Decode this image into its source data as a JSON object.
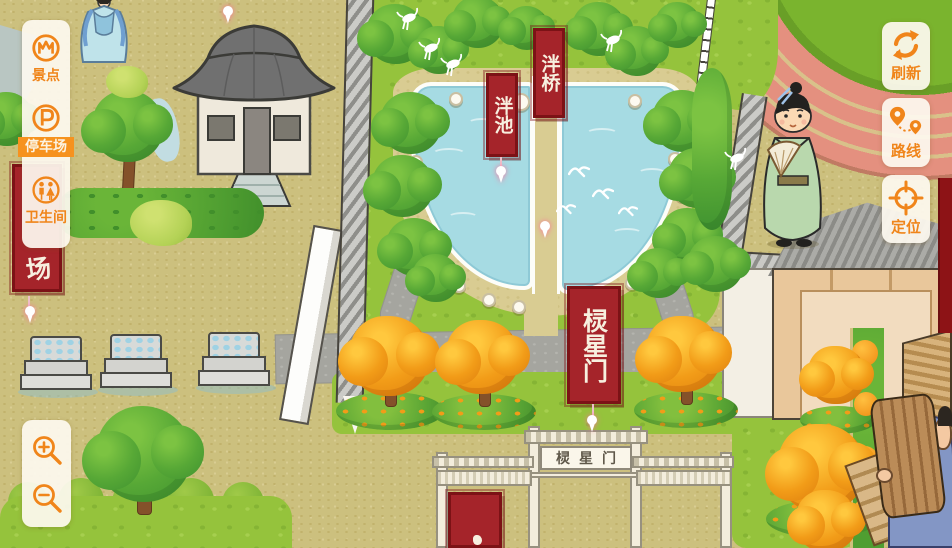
{
  "ui": {
    "accent_color": "#f0851a",
    "panel_bg": "#fdf8ee",
    "sidebar": {
      "items": [
        {
          "id": "scenic",
          "label": "景点",
          "icon": "scenic-spots-icon",
          "active": false
        },
        {
          "id": "parking",
          "label": "停车场",
          "icon": "parking-icon",
          "active": true
        },
        {
          "id": "toilet",
          "label": "卫生间",
          "icon": "restroom-icon",
          "active": false
        }
      ]
    },
    "map_tools": {
      "items": [
        {
          "id": "refresh",
          "label": "刷新",
          "icon": "refresh-icon"
        },
        {
          "id": "route",
          "label": "路线",
          "icon": "route-icon"
        },
        {
          "id": "locate",
          "label": "定位",
          "icon": "locate-icon"
        }
      ]
    },
    "zoom": {
      "zoom_in_icon": "zoom-in-icon",
      "zoom_out_icon": "zoom-out-icon"
    }
  },
  "map": {
    "poi_banners": [
      {
        "id": "pan-bridge",
        "text": "泮桥"
      },
      {
        "id": "pan-pond",
        "text": "泮池"
      },
      {
        "id": "lingxing-gate",
        "text": "棂星门"
      },
      {
        "id": "parking-lot-partial",
        "text": "场"
      }
    ],
    "gate_plaque": "棂星门",
    "colors": {
      "ground": "#ccc07e",
      "lawn": "#95c33c",
      "pond": "#a6dbe3",
      "road": "#a5a59f",
      "banner_red": "#a5242a",
      "track": "#e4907f"
    }
  }
}
